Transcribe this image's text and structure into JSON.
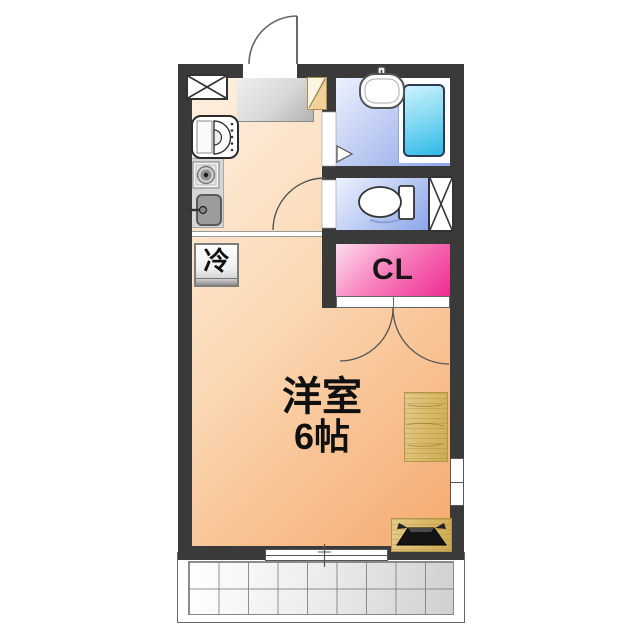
{
  "floor_plan": {
    "main_room": {
      "name": "洋室",
      "size": "6帖"
    },
    "closet_label": "CL",
    "refrigerator_label": "冷",
    "rooms": [
      "entrance",
      "kitchen",
      "western-room-6-mats",
      "bathroom",
      "toilet",
      "closet",
      "balcony"
    ],
    "fixtures": [
      "entry-door",
      "shoe-cabinet",
      "meter-box",
      "washing-machine",
      "stove-burner",
      "kitchen-sink",
      "refrigerator",
      "wash-basin",
      "bathtub",
      "bathroom-folding-door",
      "toilet",
      "pipe-space",
      "toilet-door",
      "closet-double-doors",
      "wood-counter",
      "tv",
      "sliding-window",
      "small-window",
      "balcony-tiles"
    ],
    "colors": {
      "wall": "#3a3a3a",
      "room_floor": "#f5a96e",
      "room_floor_light": "#fdf0e1",
      "wet_floor": "#8da6ea",
      "wet_floor_light": "#edf2fd",
      "bathtub": "#2fb9e8",
      "closet_pink": "#ee2b92",
      "closet_pink_light": "#fcdcee",
      "wood": "#d9b968",
      "entrance_gray": "#c9c9c9",
      "shoe_cabinet_tan": "#f2d098",
      "balcony_tile": "#dcdcdc"
    }
  }
}
